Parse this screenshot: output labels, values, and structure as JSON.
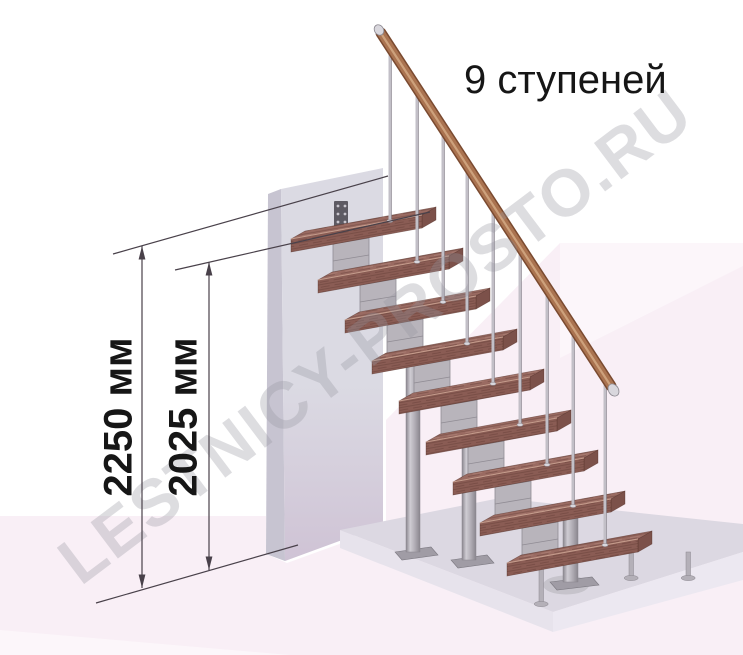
{
  "diagram": {
    "title": "9 ступеней",
    "steps_count": 9,
    "watermark": "LESTNICY-PROSTO.RU",
    "dimensions": {
      "total_height": "2250 мм",
      "height_to_top_step": "2025 мм"
    },
    "colors": {
      "tread_wood": "#9a6b62",
      "tread_grain_dark": "rgba(58,28,22,0.28)",
      "tread_grain_light": "rgba(255,226,205,0.16)",
      "tread_front": "#8a5c54",
      "tread_side": "#7c514a",
      "tread_edge_highlight": "#c59c8c",
      "tread_outline": "rgba(80,45,38,0.55)",
      "metal_light": "#cfccd3",
      "metal_mid": "#b4b0b8",
      "metal_dark": "#8a868e",
      "baluster": "#c2bfc7",
      "module": "#b8b4bb",
      "module_edge": "#908c94",
      "handrail_core": "#aa7350",
      "handrail_dark": "#7a4a30",
      "handrail_highlight": "#cda17c",
      "ferrule": "#d9d7dd",
      "wall_front_top": "#dbdae3",
      "wall_front_bottom": "#cfc3d5",
      "wall_side": "#c7c4d1",
      "bracket": "#5d5a63",
      "bracket_hole": "#c9c6ce",
      "floor_pink": "#f9eff6",
      "floor_facet_light": "rgba(255,255,255,0.45)",
      "platform_top": "#dcd8e2",
      "platform_front_left": "#e7e3ec",
      "platform_front_right": "#ece8f1",
      "plate": "#a09ca5",
      "plate_edge": "#7b7880",
      "dimension_line": "#49414a",
      "text": "#161616",
      "watermark_color": "rgba(150,148,158,0.32)",
      "background": "#ffffff"
    }
  }
}
